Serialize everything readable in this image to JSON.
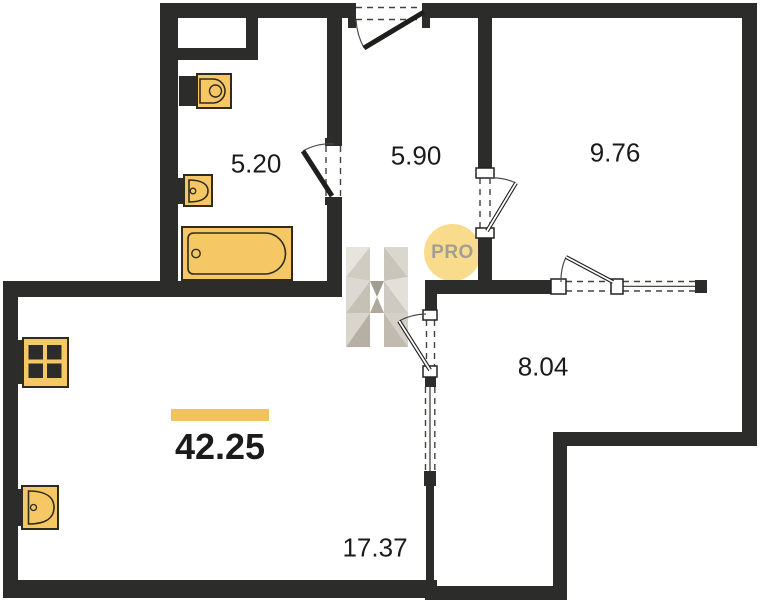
{
  "plan": {
    "rooms": [
      {
        "id": "bathroom",
        "area": "5.20"
      },
      {
        "id": "hallway",
        "area": "5.90"
      },
      {
        "id": "room-top-right",
        "area": "9.76"
      },
      {
        "id": "room-right",
        "area": "8.04"
      },
      {
        "id": "living-room",
        "area": "17.37"
      }
    ],
    "total_area": "42.25",
    "watermark": {
      "letter": "H",
      "badge": "PRO"
    },
    "fixtures": [
      "toilet",
      "bathroom-sink",
      "bathtub",
      "stove",
      "kitchen-sink"
    ],
    "colors": {
      "wall": "#2c2c2a",
      "fixture_yellow": "#f6c765",
      "accent_bar": "#efc35f",
      "badge_bg": "#f8dc8c",
      "badge_text": "#a29e96",
      "label_text": "#1b1b1b"
    }
  }
}
